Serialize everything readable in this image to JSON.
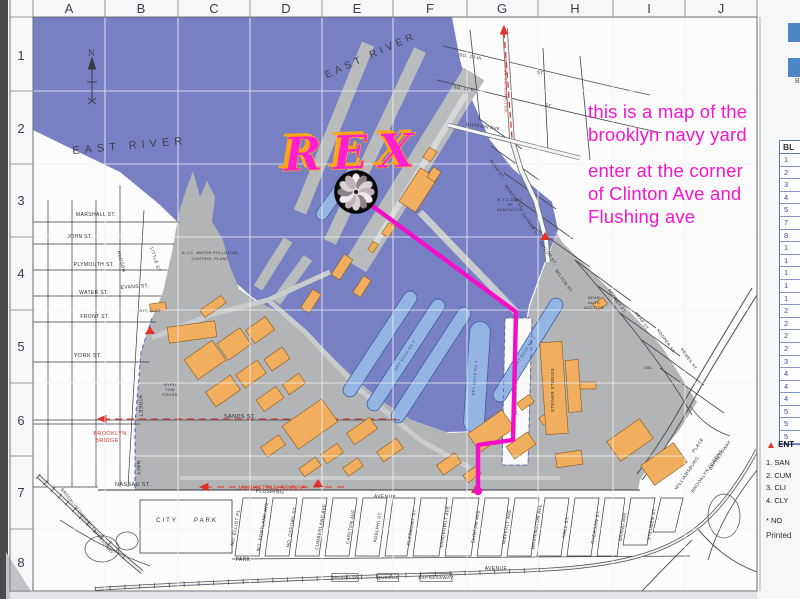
{
  "page": {
    "background": "#eceef1",
    "paper": "#f6f7f9"
  },
  "annotation": {
    "color": "#f715cf",
    "lines": [
      "this is a map of the",
      "brooklyn navy yard",
      "enter at the corner",
      "of Clinton Ave and",
      "Flushing ave"
    ]
  },
  "logo": {
    "text": "REX",
    "fill": "#ff1fd0",
    "outline": "#ffa517"
  },
  "grid": {
    "columns": [
      "A",
      "B",
      "C",
      "D",
      "E",
      "F",
      "G",
      "H",
      "I",
      "J"
    ],
    "rows": [
      "1",
      "2",
      "3",
      "4",
      "5",
      "6",
      "7",
      "8"
    ]
  },
  "compass": {
    "label": "N"
  },
  "route": {
    "color": "#f30fca",
    "points": [
      [
        371,
        205
      ],
      [
        516,
        312
      ],
      [
        513,
        440
      ],
      [
        478,
        445
      ],
      [
        478,
        489
      ]
    ],
    "end_dot": [
      478,
      491
    ]
  },
  "entrance_markers": [
    [
      150,
      334
    ],
    [
      545,
      240
    ],
    [
      318,
      487
    ],
    [
      476,
      493
    ]
  ],
  "colors": {
    "water": "#7880c4",
    "yard": "#b2b4b6",
    "pier": "#b9bbbd",
    "drydock": "#94b5e2",
    "building": "#f0ae5e",
    "building_edge": "#8a5a1a",
    "red": "#d93a2c",
    "boundary_dash": "#3344bb"
  },
  "water_labels": [
    {
      "t": "EAST  RIVER",
      "x": 130,
      "y": 149,
      "r": -5,
      "s": 11,
      "ls": 5
    },
    {
      "t": "EAST  RIVER",
      "x": 372,
      "y": 58,
      "r": -24,
      "s": 10,
      "ls": 4
    }
  ],
  "map_labels": [
    {
      "t": "MARSHALL ST.",
      "x": 96,
      "y": 216,
      "r": 0,
      "s": 5
    },
    {
      "t": "JOHN    ST.",
      "x": 80,
      "y": 238,
      "r": 0,
      "s": 5
    },
    {
      "t": "PLYMOUTH ST.",
      "x": 94,
      "y": 266,
      "r": 0,
      "s": 5
    },
    {
      "t": "EVANS  ST.",
      "x": 135,
      "y": 288,
      "r": -4,
      "s": 5
    },
    {
      "t": "WATER ST.",
      "x": 94,
      "y": 294,
      "r": 0,
      "s": 5
    },
    {
      "t": "FRONT ST.",
      "x": 95,
      "y": 318,
      "r": 0,
      "s": 5
    },
    {
      "t": "YORK   ST.",
      "x": 88,
      "y": 357,
      "r": 0,
      "s": 5.5
    },
    {
      "t": "SANDS   ST.",
      "x": 240,
      "y": 418,
      "r": 0,
      "s": 5.5
    },
    {
      "t": "NASSAU  ST.",
      "x": 133,
      "y": 486,
      "r": 0,
      "s": 5.5
    },
    {
      "t": "HUDSON",
      "x": 120,
      "y": 262,
      "r": 75,
      "s": 4.5
    },
    {
      "t": "LITTLE  ST",
      "x": 154,
      "y": 260,
      "r": 72,
      "s": 4.5
    },
    {
      "t": "NAVY",
      "x": 137,
      "y": 468,
      "r": 88,
      "s": 5
    },
    {
      "t": "STREET",
      "x": 139,
      "y": 406,
      "r": 88,
      "s": 5
    },
    {
      "t": "CITY",
      "x": 167,
      "y": 522,
      "r": 0,
      "s": 6,
      "ls": 2
    },
    {
      "t": "PARK",
      "x": 206,
      "y": 522,
      "r": 0,
      "s": 6,
      "ls": 2
    },
    {
      "t": "PARK",
      "x": 243,
      "y": 561,
      "r": 0,
      "s": 5
    },
    {
      "t": "AVENUE",
      "x": 496,
      "y": 570,
      "r": 0,
      "s": 5
    },
    {
      "t": "FLUSHING",
      "x": 270,
      "y": 493,
      "r": 2,
      "s": 5
    },
    {
      "t": "AVENUE",
      "x": 385,
      "y": 498,
      "r": 2,
      "s": 5
    },
    {
      "t": "NO. ELLIOT PL.",
      "x": 237,
      "y": 527,
      "r": -80,
      "s": 4.5
    },
    {
      "t": "NO. PORTLAND AVE",
      "x": 264,
      "y": 527,
      "r": -80,
      "s": 4.5
    },
    {
      "t": "NO. OXFORD ST.",
      "x": 293,
      "y": 527,
      "r": -80,
      "s": 4.5
    },
    {
      "t": "CUMBERLAND AVE",
      "x": 322,
      "y": 527,
      "r": -80,
      "s": 4.5
    },
    {
      "t": "CARLTON AVE",
      "x": 352,
      "y": 527,
      "r": -80,
      "s": 4.5
    },
    {
      "t": "ADELPHI ST.",
      "x": 379,
      "y": 527,
      "r": -80,
      "s": 4.5
    },
    {
      "t": "CLERMONT ST.",
      "x": 413,
      "y": 527,
      "r": -80,
      "s": 4.5
    },
    {
      "t": "VANDERBILT AVE",
      "x": 446,
      "y": 527,
      "r": -80,
      "s": 4.5
    },
    {
      "t": "CLINTON AVE",
      "x": 477,
      "y": 527,
      "r": -80,
      "s": 4.5
    },
    {
      "t": "WAVERLY AVE",
      "x": 508,
      "y": 527,
      "r": -80,
      "s": 4.5
    },
    {
      "t": "WASHINGTON AVE",
      "x": 538,
      "y": 527,
      "r": -80,
      "s": 4.5
    },
    {
      "t": "HALL ST.",
      "x": 567,
      "y": 527,
      "r": -80,
      "s": 4.5
    },
    {
      "t": "RYERSON ST.",
      "x": 597,
      "y": 527,
      "r": -80,
      "s": 4.5
    },
    {
      "t": "GRAND AVE",
      "x": 624,
      "y": 527,
      "r": -80,
      "s": 4.5
    },
    {
      "t": "STEUBEN ST.",
      "x": 653,
      "y": 524,
      "r": -80,
      "s": 4.5
    },
    {
      "t": "SO. 10 th",
      "x": 470,
      "y": 58,
      "r": 10,
      "s": 4.5
    },
    {
      "t": "ST",
      "x": 540,
      "y": 74,
      "r": 10,
      "s": 4.5
    },
    {
      "t": "SO. 11 th",
      "x": 464,
      "y": 90,
      "r": 10,
      "s": 4.5
    },
    {
      "t": "ST",
      "x": 548,
      "y": 107,
      "r": 10,
      "s": 4.5
    },
    {
      "t": "DIVISION  AVE",
      "x": 483,
      "y": 128,
      "r": 8,
      "s": 4.5
    },
    {
      "t": "RUSH ST.",
      "x": 496,
      "y": 170,
      "r": 55,
      "s": 4.2
    },
    {
      "t": "NORTON ST.",
      "x": 513,
      "y": 198,
      "r": 55,
      "s": 4.2
    },
    {
      "t": "CLYMER ST.",
      "x": 530,
      "y": 226,
      "r": 55,
      "s": 4.2
    },
    {
      "t": "TAYLOR ST.",
      "x": 547,
      "y": 254,
      "r": 55,
      "s": 4.2
    },
    {
      "t": "WILSON ST.",
      "x": 563,
      "y": 282,
      "r": 55,
      "s": 4.2
    },
    {
      "t": "RODNEY ST.",
      "x": 616,
      "y": 302,
      "r": 55,
      "s": 4.2
    },
    {
      "t": "KEAP ST.",
      "x": 641,
      "y": 322,
      "r": 55,
      "s": 4.2
    },
    {
      "t": "HOOPER ST.",
      "x": 665,
      "y": 342,
      "r": 55,
      "s": 4.2
    },
    {
      "t": "HEWES ST.",
      "x": 688,
      "y": 360,
      "r": 55,
      "s": 4.2
    },
    {
      "t": "WILLIAMSBURG",
      "x": 688,
      "y": 474,
      "r": -55,
      "s": 4.5
    },
    {
      "t": "PLACE",
      "x": 699,
      "y": 446,
      "r": -55,
      "s": 4.5
    },
    {
      "t": "BROOKLYN  QUEENS",
      "x": 708,
      "y": 472,
      "r": -55,
      "s": 4.5
    },
    {
      "t": "EXPRESSWAY",
      "x": 721,
      "y": 456,
      "r": -55,
      "s": 4.5
    },
    {
      "t": "BROOKLYN QUEENS EXPRESSWAY",
      "x": 86,
      "y": 522,
      "r": 52,
      "s": 4.2
    },
    {
      "t": "N.Y.C.  WATER  POLLUTION",
      "x": 210,
      "y": 254,
      "r": 0,
      "s": 3.8
    },
    {
      "t": "CONTROL    PLANT",
      "x": 210,
      "y": 260,
      "r": 0,
      "s": 3.8
    },
    {
      "t": "NYC DEPT",
      "x": 150,
      "y": 312,
      "r": 0,
      "s": 3.5
    },
    {
      "t": "NYPD",
      "x": 170,
      "y": 386,
      "r": 0,
      "s": 3.8
    },
    {
      "t": "TOW",
      "x": 170,
      "y": 391,
      "r": 0,
      "s": 3.8
    },
    {
      "t": "POUND",
      "x": 170,
      "y": 396,
      "r": 0,
      "s": 3.8
    },
    {
      "t": "N.Y.C DEPT",
      "x": 510,
      "y": 201,
      "r": 0,
      "s": 3.8
    },
    {
      "t": "OF",
      "x": 510,
      "y": 206,
      "r": 0,
      "s": 3.8
    },
    {
      "t": "SANITATION",
      "x": 510,
      "y": 211,
      "r": 0,
      "s": 3.8
    },
    {
      "t": "DEAR",
      "x": 594,
      "y": 299,
      "r": 0,
      "s": 3.8
    },
    {
      "t": "AUTO",
      "x": 594,
      "y": 304,
      "r": 0,
      "s": 3.8
    },
    {
      "t": "AUCTION",
      "x": 594,
      "y": 309,
      "r": 0,
      "s": 3.8
    },
    {
      "t": "WASHINGTON   AVENUE",
      "x": 517,
      "y": 388,
      "r": -90,
      "s": 4.2
    },
    {
      "t": "STEINER STUDIOS",
      "x": 554,
      "y": 390,
      "r": -90,
      "s": 4.2
    },
    {
      "t": "INC.",
      "x": 649,
      "y": 369,
      "r": 0,
      "s": 4
    },
    {
      "t": "DRY DOCK NO 2",
      "x": 406,
      "y": 356,
      "r": -57,
      "s": 3.8,
      "c": "#33508f"
    },
    {
      "t": "DRY DOCK NO 4",
      "x": 476,
      "y": 378,
      "r": -85,
      "s": 3.8,
      "c": "#33508f"
    },
    {
      "t": "DRY DOCK NO 1",
      "x": 526,
      "y": 352,
      "r": -57,
      "s": 3.8,
      "c": "#33508f"
    },
    {
      "t": "BROOKLYN",
      "x": 345,
      "y": 579,
      "r": 0,
      "s": 4.5,
      "box": true
    },
    {
      "t": "QUEENS",
      "x": 388,
      "y": 579,
      "r": 0,
      "s": 4.5,
      "box": true
    },
    {
      "t": "EXPRESSWAY",
      "x": 436,
      "y": 579,
      "r": 0,
      "s": 4.5,
      "box": true
    }
  ],
  "red_labels": [
    {
      "t": "BROOKLYN",
      "x": 110,
      "y": 435,
      "r": 0,
      "s": 5.5
    },
    {
      "t": "BRIDGE",
      "x": 107,
      "y": 442,
      "r": 0,
      "s": 5.5
    },
    {
      "t": "MANHATTAN  BRIDGE",
      "x": 272,
      "y": 490,
      "r": 0,
      "s": 6
    },
    {
      "t": "WILLIAMSBURG BRIDGE",
      "x": 507,
      "y": 85,
      "r": -90,
      "s": 4
    }
  ],
  "buildings": [
    [
      168,
      324,
      48,
      16,
      -8
    ],
    [
      150,
      303,
      16,
      8,
      -8
    ],
    [
      200,
      302,
      26,
      9,
      -35
    ],
    [
      188,
      348,
      34,
      24,
      -35
    ],
    [
      220,
      334,
      28,
      20,
      -35
    ],
    [
      248,
      322,
      24,
      16,
      -35
    ],
    [
      208,
      382,
      30,
      18,
      -35
    ],
    [
      238,
      366,
      26,
      16,
      -35
    ],
    [
      266,
      352,
      22,
      14,
      -35
    ],
    [
      258,
      392,
      24,
      14,
      -35
    ],
    [
      284,
      378,
      20,
      12,
      -35
    ],
    [
      286,
      410,
      48,
      28,
      -35
    ],
    [
      262,
      440,
      22,
      12,
      -35
    ],
    [
      322,
      448,
      20,
      11,
      -35
    ],
    [
      344,
      462,
      18,
      10,
      -35
    ],
    [
      348,
      424,
      28,
      14,
      -35
    ],
    [
      378,
      444,
      24,
      12,
      -35
    ],
    [
      300,
      462,
      20,
      10,
      -35
    ],
    [
      398,
      180,
      40,
      20,
      -57
    ],
    [
      424,
      150,
      12,
      9,
      -57
    ],
    [
      428,
      170,
      12,
      9,
      -57
    ],
    [
      382,
      226,
      13,
      8,
      -57
    ],
    [
      368,
      244,
      10,
      6,
      -57
    ],
    [
      330,
      262,
      24,
      10,
      -57
    ],
    [
      352,
      282,
      20,
      9,
      -57
    ],
    [
      470,
      420,
      42,
      22,
      -35
    ],
    [
      508,
      438,
      26,
      15,
      -35
    ],
    [
      438,
      458,
      22,
      12,
      -35
    ],
    [
      464,
      470,
      16,
      9,
      -35
    ],
    [
      518,
      398,
      15,
      9,
      -35
    ],
    [
      540,
      414,
      13,
      8,
      -35
    ],
    [
      543,
      342,
      22,
      92,
      -4
    ],
    [
      567,
      360,
      13,
      52,
      -4
    ],
    [
      580,
      382,
      16,
      7,
      0
    ],
    [
      610,
      428,
      40,
      24,
      -35
    ],
    [
      644,
      452,
      40,
      24,
      -35
    ],
    [
      556,
      452,
      26,
      14,
      -8
    ],
    [
      594,
      300,
      12,
      8,
      -35
    ],
    [
      300,
      296,
      22,
      10,
      -57
    ]
  ],
  "dry_docks": [
    [
      350,
      390,
      410,
      298,
      13
    ],
    [
      374,
      404,
      438,
      306,
      13
    ],
    [
      398,
      416,
      464,
      314,
      13
    ],
    [
      474,
      422,
      480,
      332,
      20
    ],
    [
      500,
      395,
      556,
      305,
      13
    ],
    [
      322,
      214,
      352,
      172,
      11
    ]
  ],
  "building_table": {
    "header": "BL",
    "rows": [
      "1",
      "2",
      "3",
      "4",
      "5",
      "7",
      "8",
      "1",
      "1",
      "1",
      "1",
      "1",
      "2",
      "2",
      "2",
      "2",
      "3",
      "4",
      "4",
      "4",
      "5",
      "5",
      "5"
    ]
  },
  "legend": {
    "marker_label": "ENT",
    "entrances": [
      "1.  SAN",
      "2.  CUM",
      "3.  CLI",
      "4.  CLY"
    ],
    "note": "*    NO",
    "printed": "Printed"
  },
  "swatches": {
    "color": "#4f86c6",
    "partial_label": "B"
  }
}
